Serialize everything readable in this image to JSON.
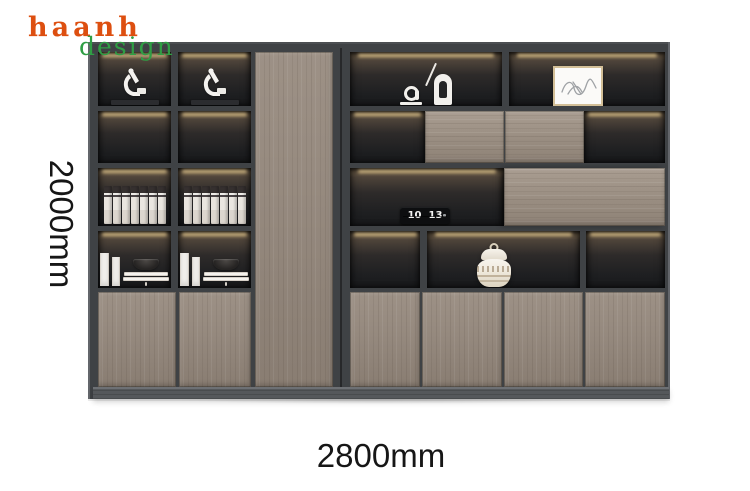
{
  "brand": {
    "name": "haanh",
    "tagline": "design"
  },
  "dimensions": {
    "height_label": "2000mm",
    "width_label": "2800mm"
  },
  "clock": {
    "hours": "10",
    "minutes": "13"
  },
  "palette": {
    "background": "#ffffff",
    "brand_orange": "#dd4f10",
    "brand_green": "#2f9e44",
    "dim_text": "#161616",
    "frame": "#3f4245",
    "frame_light": "#63666b",
    "interior_dark": "#1b1c1e",
    "led_glow": "#e9cd93",
    "wood": "#95897e",
    "wood_shadow": "#7e7368",
    "plinth": "#55585b",
    "object_white": "#f2f0ec"
  },
  "decor": {
    "left_unit_shelves": [
      "microscope-ornament",
      "empty-lit-shelf",
      "file-binders",
      "books-and-bowl",
      "wood-doors"
    ],
    "right_unit_shelves": [
      "abstract-sculptures",
      "framed-artwork",
      "wood-sliding-panels",
      "flip-clock",
      "wood-panel",
      "ceramic-jar",
      "wood-doors"
    ],
    "binders_per_shelf": 7
  }
}
